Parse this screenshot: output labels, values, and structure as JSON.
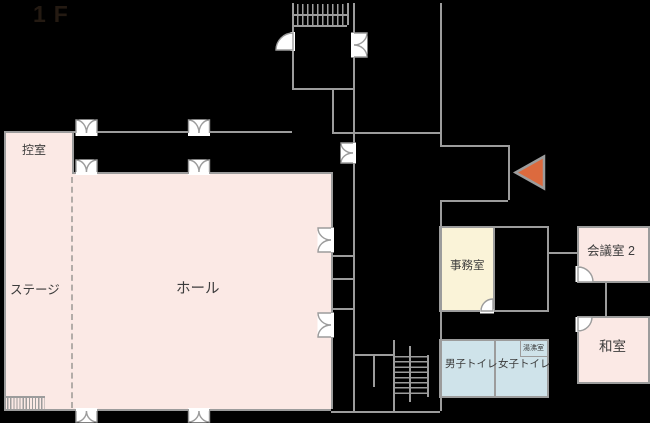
{
  "title": "1F",
  "rooms": {
    "hikaeshitsu": "控室",
    "stage": "ステージ",
    "hall": "ホール",
    "office": "事務室",
    "meeting2": "会議室 2",
    "washitsu": "和室",
    "mens_toilet": "男子トイレ",
    "womens_toilet": "女子トイレ",
    "kitchenette": "湯沸室"
  },
  "icons": {
    "entrance_arrow": "left-pointing-entrance-arrow",
    "double_door": "double-swing-door",
    "door_swing": "single-door-swing-arc",
    "staircase": "staircase",
    "stage_steps": "stage-steps"
  },
  "colors": {
    "wall": "#9c9c9c",
    "hall_pink": "#fbe9e5",
    "office_cream": "#faf3d8",
    "toilet_blue": "#cfe3ea",
    "entrance_arrow_orange": "#dc6a3e",
    "label_text": "#3c3c3c",
    "background": "#000000"
  }
}
